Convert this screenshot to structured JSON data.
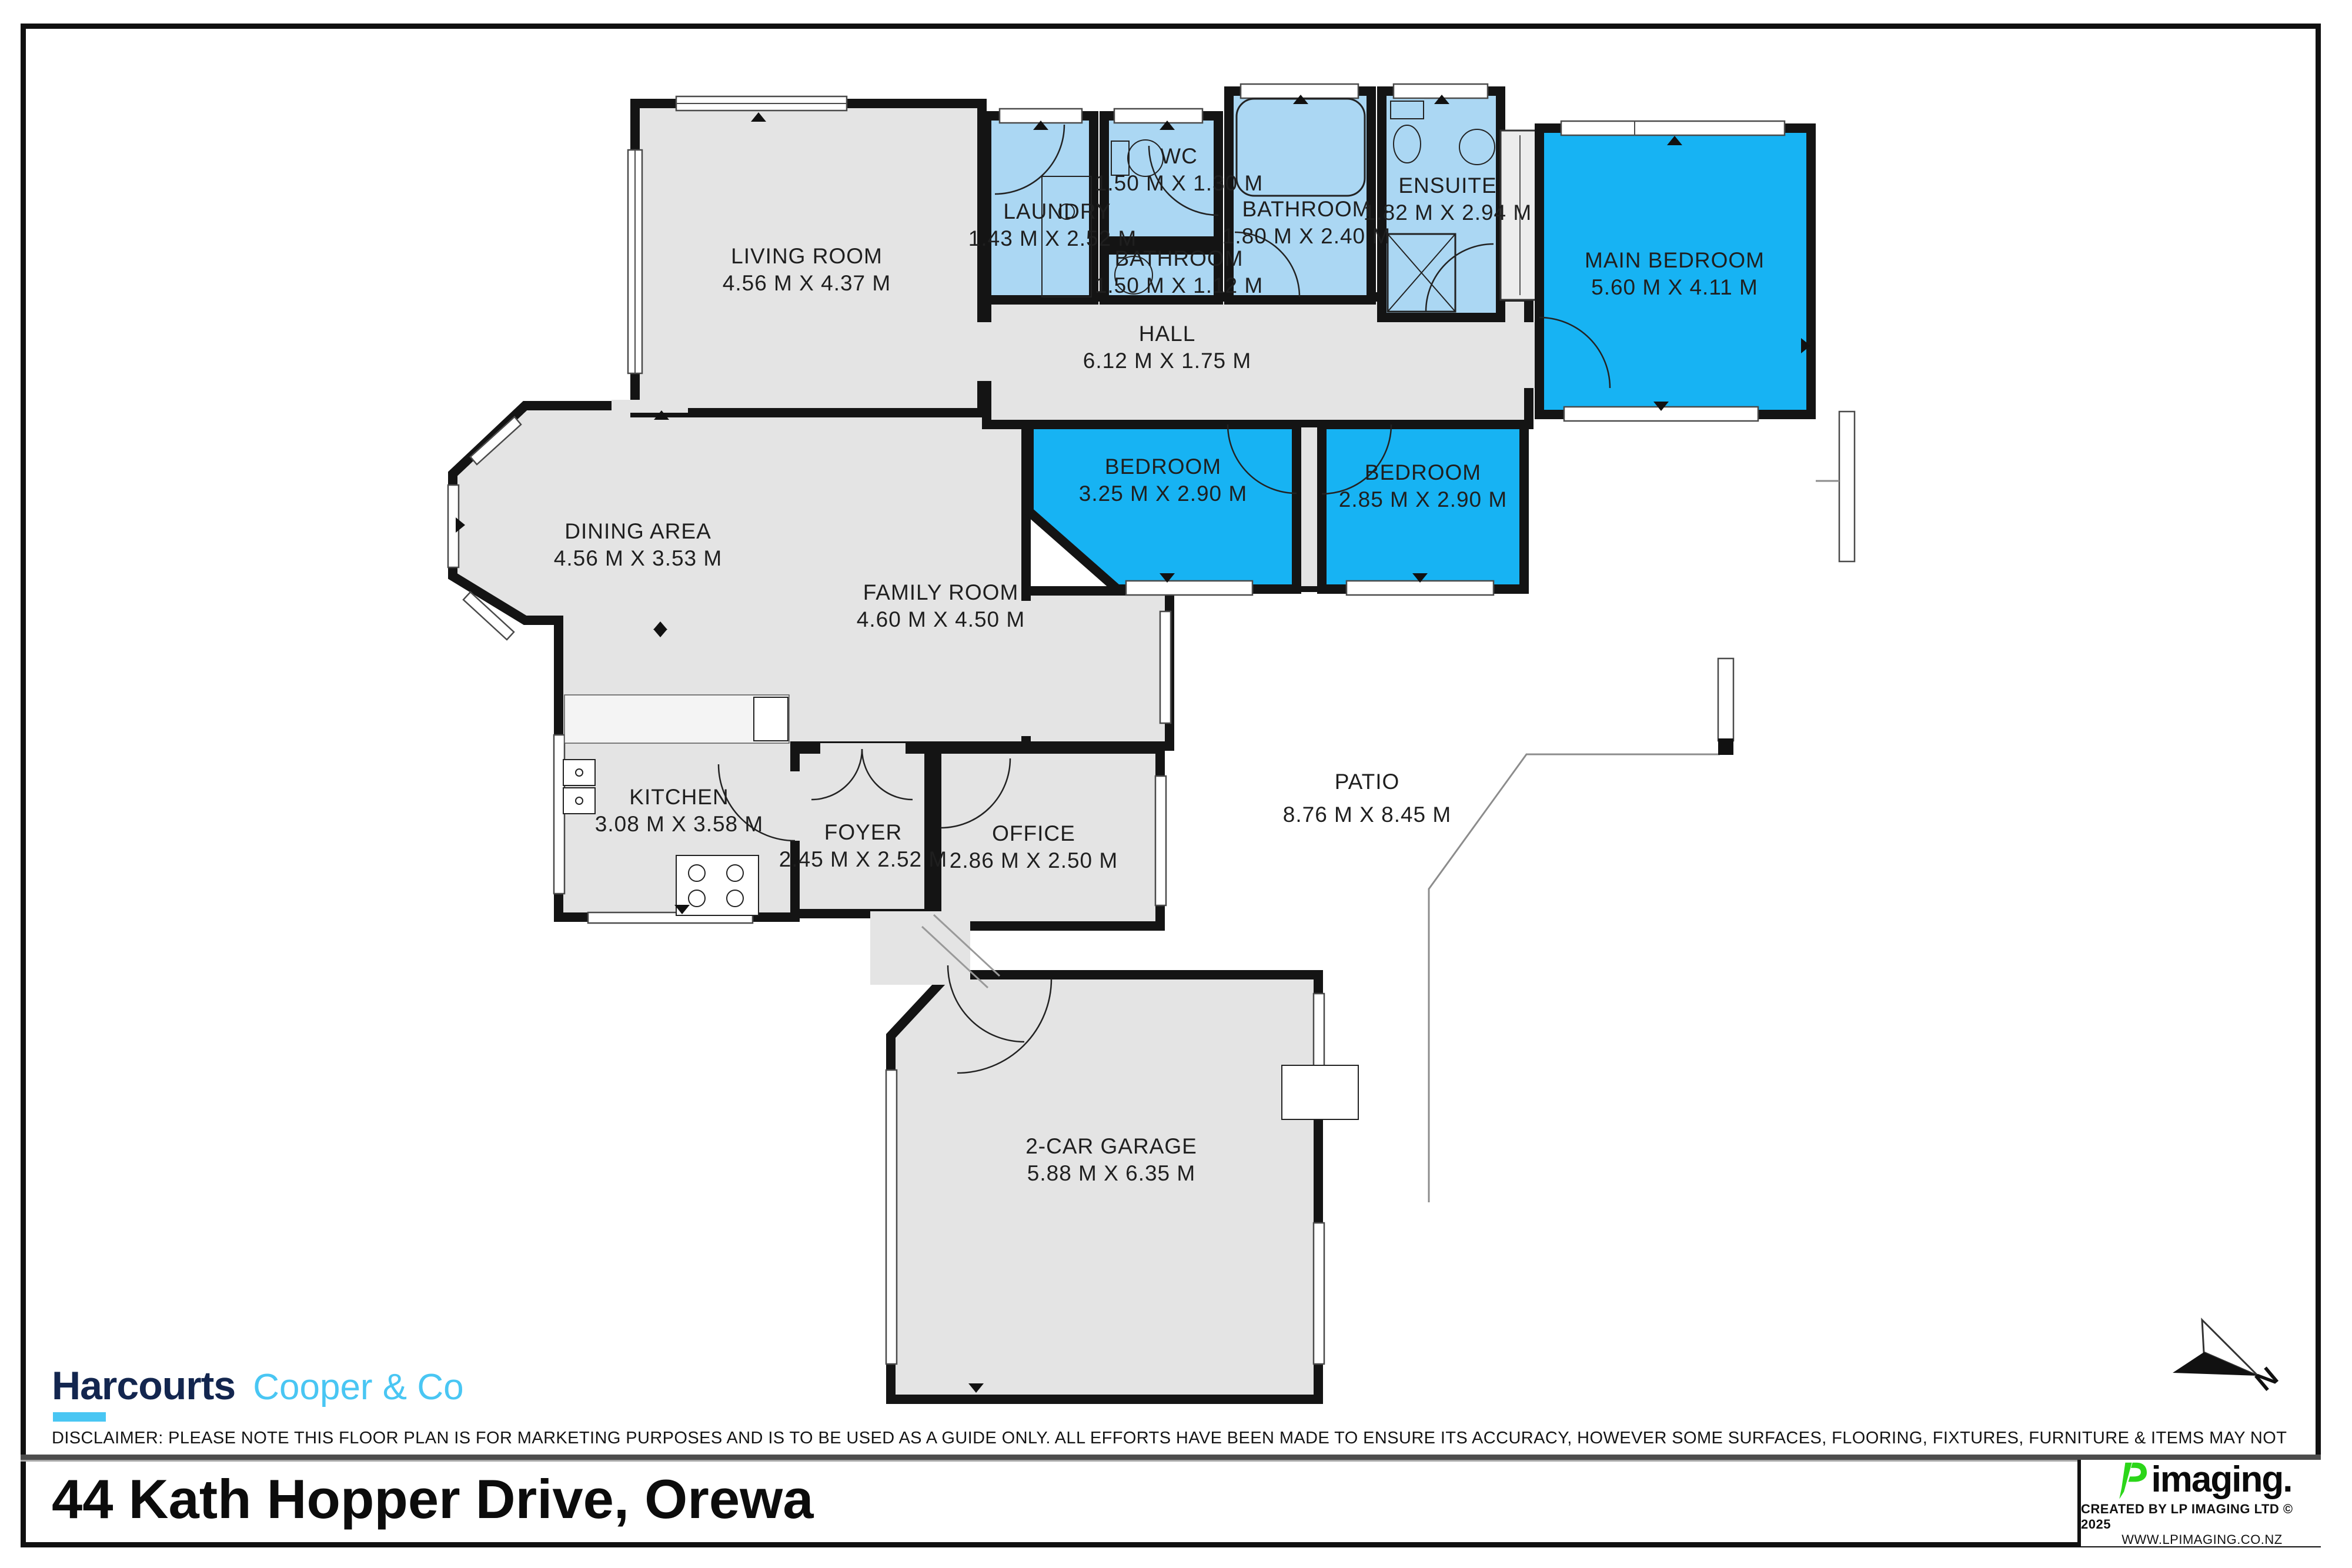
{
  "floorplan": {
    "rooms": [
      {
        "id": "living-room",
        "label": "LIVING ROOM",
        "dims": "4.56 M X 4.37 M"
      },
      {
        "id": "dining-area",
        "label": "DINING AREA",
        "dims": "4.56 M X 3.53 M"
      },
      {
        "id": "family-room",
        "label": "FAMILY ROOM",
        "dims": "4.60 M X 4.50 M"
      },
      {
        "id": "kitchen",
        "label": "KITCHEN",
        "dims": "3.08 M X 3.58 M"
      },
      {
        "id": "foyer",
        "label": "FOYER",
        "dims": "2.45 M X 2.52 M"
      },
      {
        "id": "office",
        "label": "OFFICE",
        "dims": "2.86 M X 2.50 M"
      },
      {
        "id": "laundry",
        "label": "LAUNDRY",
        "dims": "1.43 M X 2.52 M"
      },
      {
        "id": "wc",
        "label": "WC",
        "dims": "1.50 M X 1.30 M"
      },
      {
        "id": "bathroom",
        "label": "BATHROOM",
        "dims": "1.80 M X 2.40 M"
      },
      {
        "id": "bathroom-2",
        "label": "BATHROOM",
        "dims": "1.50 M X 1.12 M"
      },
      {
        "id": "ensuite",
        "label": "ENSUITE",
        "dims": "1.82 M X 2.94 M"
      },
      {
        "id": "hall",
        "label": "HALL",
        "dims": "6.12 M X 1.75 M"
      },
      {
        "id": "main-bedroom",
        "label": "MAIN BEDROOM",
        "dims": "5.60 M X 4.11 M"
      },
      {
        "id": "bedroom-1",
        "label": "BEDROOM",
        "dims": "3.25 M X 2.90 M"
      },
      {
        "id": "bedroom-2",
        "label": "BEDROOM",
        "dims": "2.85 M X 2.90 M"
      },
      {
        "id": "patio",
        "label": "PATIO",
        "dims": "8.76 M X 8.45 M"
      },
      {
        "id": "garage",
        "label": "2-CAR GARAGE",
        "dims": "5.88 M X 6.35 M"
      }
    ],
    "compass_label": "N"
  },
  "footer": {
    "brand": {
      "primary": "Harcourts",
      "secondary": "Cooper & Co"
    },
    "disclaimer": "DISCLAIMER: PLEASE NOTE THIS FLOOR PLAN IS FOR MARKETING PURPOSES AND IS TO BE USED AS A GUIDE ONLY. ALL EFFORTS HAVE BEEN MADE TO ENSURE ITS ACCURACY, HOWEVER SOME SURFACES, FLOORING, FIXTURES, FURNITURE & ITEMS MAY NOT REPRESENT THE ACTUAL PROPERTY.",
    "address": "44 Kath Hopper Drive, Orewa",
    "credit": {
      "logo_text": "imaging.",
      "line1": "CREATED BY LP IMAGING LTD © 2025",
      "line2": "WWW.LPIMAGING.CO.NZ"
    }
  },
  "colors": {
    "bedroom": "#17b3f3",
    "bathroom": "#abd7f3",
    "floor": "#e4e4e4",
    "wall": "#141414",
    "harcourts_navy": "#13264f",
    "harcourts_blue": "#49c6f3",
    "lp_green": "#2bd619"
  }
}
